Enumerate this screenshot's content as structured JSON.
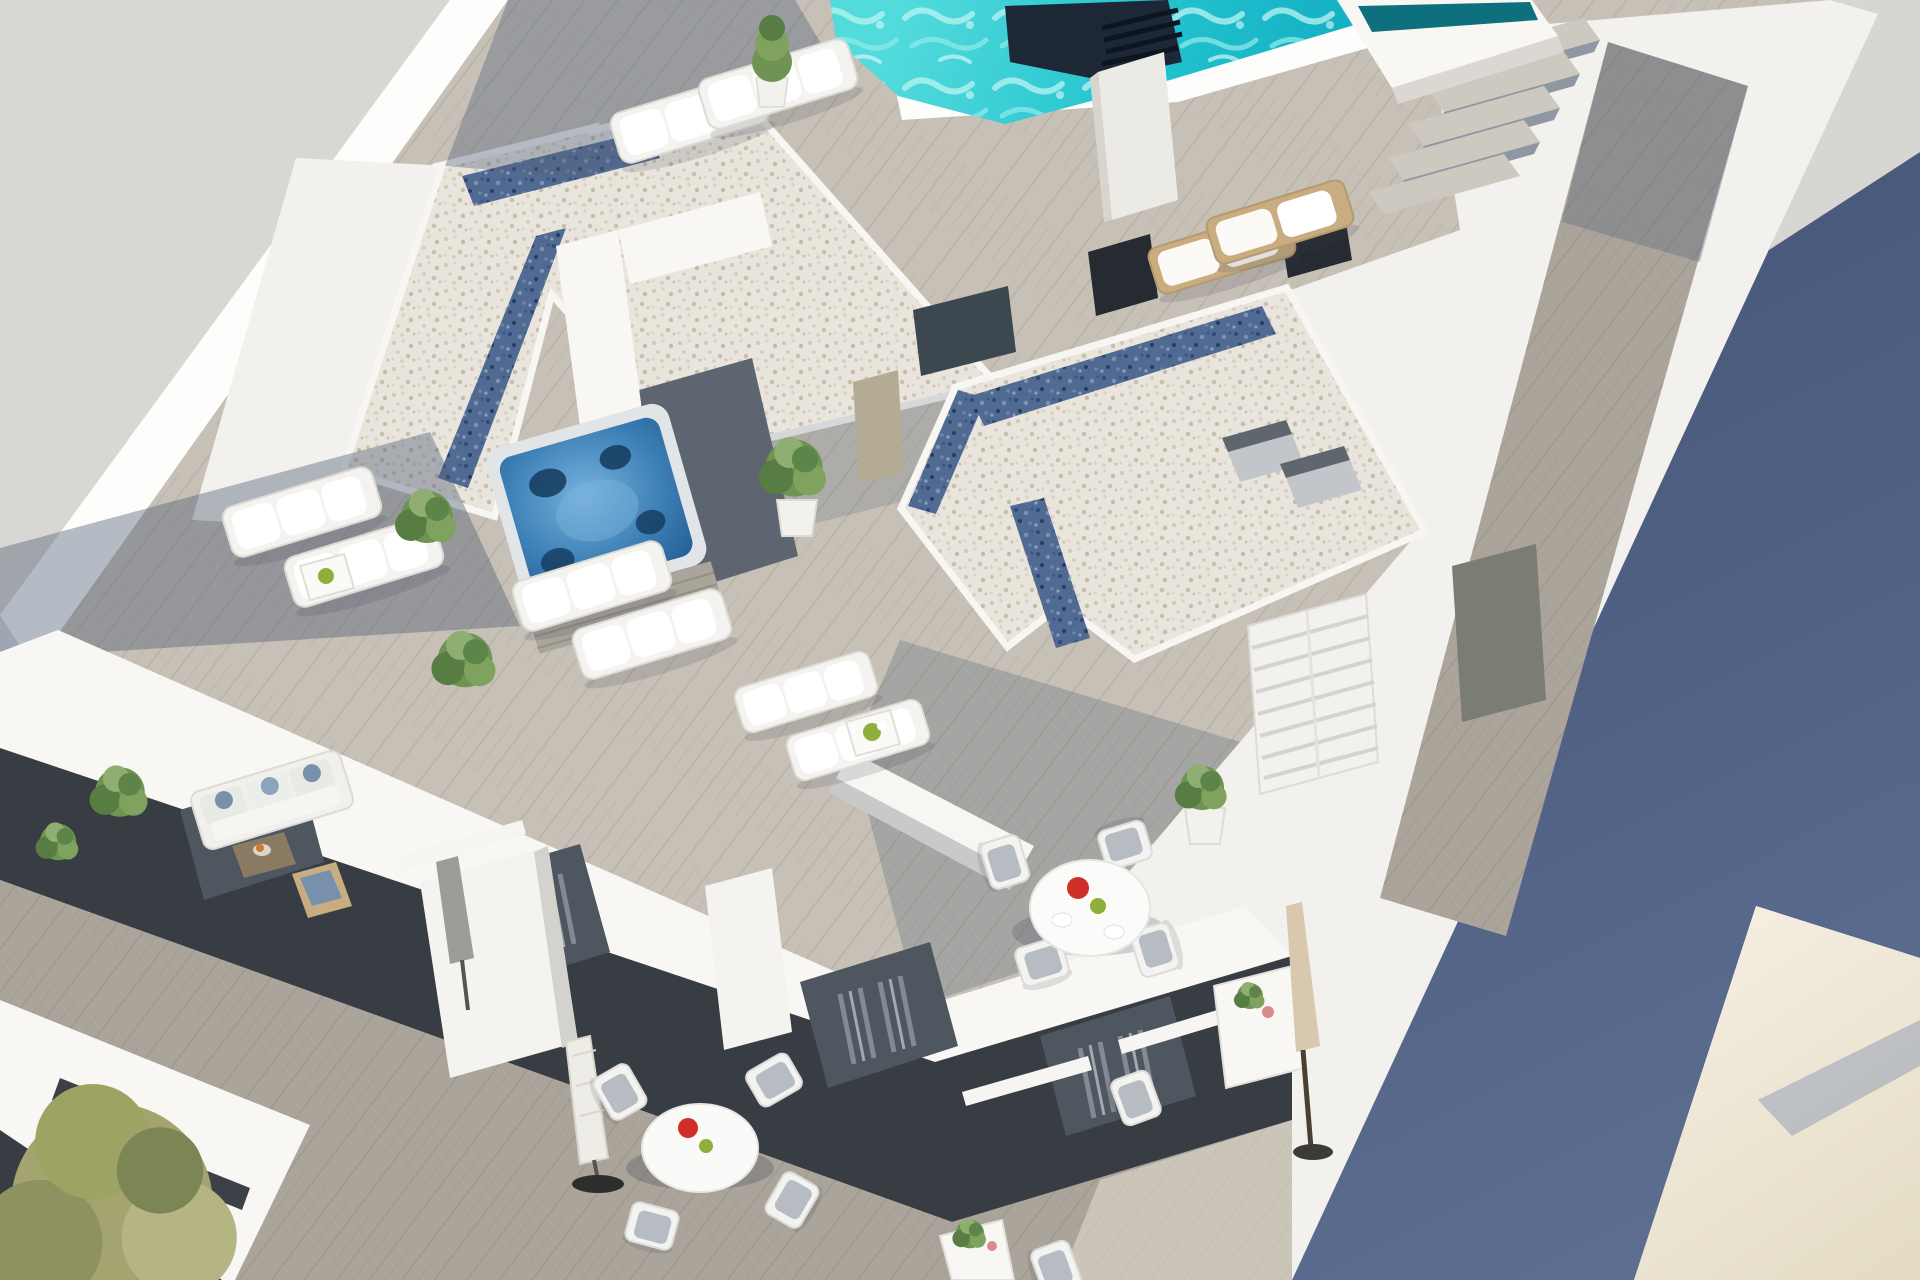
{
  "image": {
    "type": "3d-architectural-rendering",
    "view": "aerial-isometric",
    "subject": "rooftop solarium terraces of a modern white apartment building with pool, jacuzzi and balconies",
    "lighting": "bright sunny daylight with long blue shadows"
  },
  "colors": {
    "base": "#ece9e5",
    "neighborRoof": "#d9d7d3",
    "topRightGray": "#d8d6d2",
    "wallWhite": "#f8f7f4",
    "wallBright": "#fdfdfb",
    "wallShade": "#dbd8d3",
    "buildingBase": "#f3f1ed",
    "deckSun": "#c6c0b6",
    "deckMid": "#aaa49b",
    "deckShade": "#747e8c",
    "gravelWhite": "#e9e5dc",
    "gravelBlue": "#516a92",
    "pool": "#23c3cf",
    "poolDeep": "#0fa9c0",
    "tealEdge": "#0e6f7d",
    "chimneyDark": "#1c2836",
    "shadowBlue": "#49597c",
    "beigeWall": "#efe9dc",
    "facadeDark": "#383d44",
    "glassDark": "#4e565f",
    "curtain": "#969ca6",
    "jacuzziWater": "#3c7fb5",
    "seatNavy": "#14395c",
    "skirt": "#aaa59b",
    "plantGreen": "#6f9352",
    "plantLight": "#8fae71",
    "plantDark": "#48663a",
    "plantOlive": "#a3a46f",
    "teak": "#c9ad80",
    "woodBrown": "#8a7a62",
    "sofaBlue": "#7791ad",
    "accentRed": "#cf2f27",
    "accentGreen": "#8fae3b",
    "umbrellaTan": "#d8c9ae",
    "umbrellaGray": "#9c9c98",
    "metalGray": "#c2c5c9",
    "darkBase": "#2e2e2c",
    "doorTan": "#b3ab94",
    "doorGray": "#7b7d74",
    "windowDark": "#262b31",
    "frameWhite": "#f6f5f1"
  },
  "elements": {
    "pool": "turquoise rooftop swimming pool with raised spa ledge",
    "stairs": "white steps beside the pool",
    "chimney": "dark louvered chimney vent at pool edge",
    "gravel_roofs": "white pebble roof volumes with blue glass skylight strips",
    "jacuzzi": "square hot tub with panelled skirt in a private nook",
    "sun_loungers": "eight white sun loungers in four pairs",
    "dining_set_main": "round white table with four chairs, red plate and green bowl",
    "dining_set_lower": "round white table with chairs on lower balcony",
    "bistro_set": "small white side table with chair and folded tan umbrella",
    "umbrellas": "three folded parasols (white, gray, tan)",
    "planters": "white tapered pots with green shrubs and one conical cypress",
    "sofa": "lounge sofa with blue cushions on left balcony",
    "facades": "dark glazed balcony facades with gray curtains",
    "shadow_ground": "deep blue-gray shadow cast at right side",
    "beige_wall": "sunlit beige wall in lower right corner"
  }
}
